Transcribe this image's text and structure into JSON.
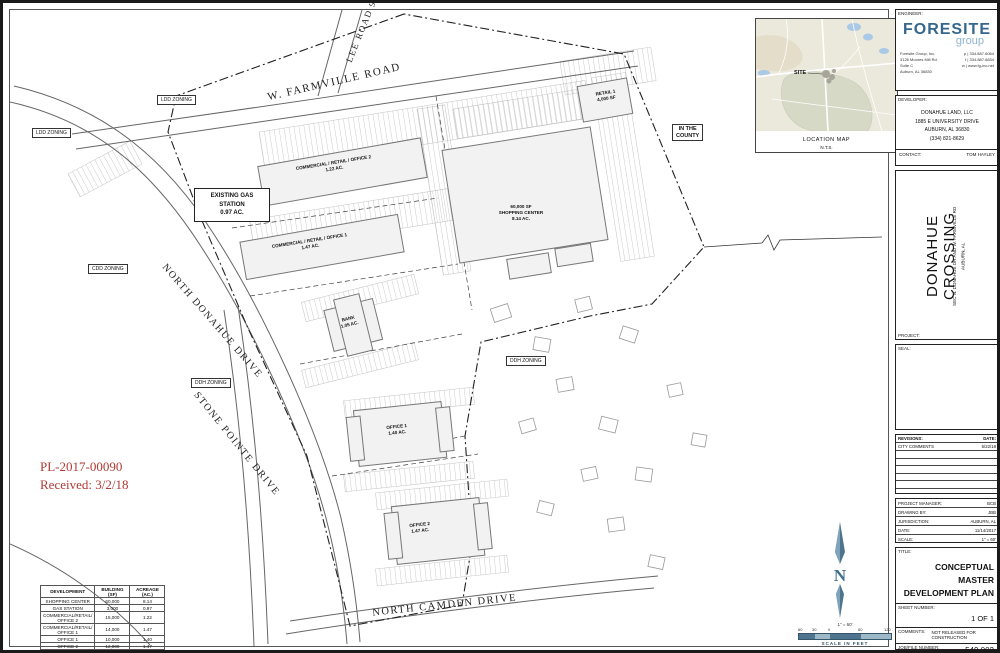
{
  "plan": {
    "roads": {
      "farmville": "W. FARMVILLE ROAD",
      "lee": "LEE ROAD 91",
      "donahue": "NORTH DONAHUE DRIVE",
      "stone_pointe": "STONE POINTE DRIVE",
      "camden": "NORTH CAMDEN DRIVE"
    },
    "zoning": {
      "ldd": "LDD ZONING",
      "cdd": "CDD ZONING",
      "ddh": "DDH ZONING",
      "county1": "IN THE",
      "county2": "COUNTY"
    },
    "parcels": {
      "gas1": "EXISTING GAS STATION",
      "gas2": "0.97 AC.",
      "cro2_1": "COMMERCIAL / RETAIL / OFFICE 2",
      "cro2_2": "1.22 AC.",
      "cro1_1": "COMMERCIAL / RETAIL / OFFICE 1",
      "cro1_2": "1.47 AC.",
      "shop1": "60,000 SF",
      "shop2": "SHOPPING CENTER",
      "shop3": "8.14 AC.",
      "retail1_1": "RETAIL 1",
      "retail1_2": "4,000 SF",
      "bank1": "BANK",
      "bank2": "1.05 AC.",
      "office1_1": "OFFICE 1",
      "office1_2": "1.40 AC.",
      "office2_1": "OFFICE 2",
      "office2_2": "1.47 AC."
    }
  },
  "stamp": {
    "line1": "PL-2017-00090",
    "line2": "Received: 3/2/18",
    "color": "#b03a34"
  },
  "dev_table": {
    "headers": [
      "DEVELOPMENT",
      "BUILDING (SF)",
      "ACREAGE (AC.)"
    ],
    "rows": [
      [
        "SHOPPING CENTER",
        "60,000",
        "8.14"
      ],
      [
        "GAS STATION",
        "3,000",
        "0.97"
      ],
      [
        "COMMERCIAL/RETAIL/ OFFICE 2",
        "15,000",
        "1.22"
      ],
      [
        "COMMERCIAL/RETAIL/ OFFICE 1",
        "14,000",
        "1.47"
      ],
      [
        "OFFICE 1",
        "10,000",
        "1.40"
      ],
      [
        "OFFICE 2",
        "12,000",
        "1.47"
      ],
      [
        "RETAIL 1",
        "4,000",
        ""
      ],
      [
        "BANK",
        "4,000",
        "1.05"
      ]
    ]
  },
  "location_map": {
    "site_label": "SITE",
    "caption1": "LOCATION MAP",
    "caption2": "N.T.S."
  },
  "north_scale": {
    "north_letter": "N",
    "scale_text": "1\" = 60'",
    "ticks": [
      "60",
      "30",
      "0",
      "60",
      "120"
    ],
    "caption": "SCALE IN FEET",
    "arrow_color": "#4e7490",
    "bar_light": "#9db8c6"
  },
  "titleblock": {
    "engineer_label": "ENGINEER:",
    "logo_main": "FORESITE",
    "logo_sub": "group",
    "logo_color": "#35678e",
    "logo_sub_color": "#8fb4cc",
    "firm_left": [
      "Foresite Group, Inc.",
      "3126 Moores Mill Rd.",
      "Suite C",
      "Auburn, AL 36830"
    ],
    "firm_right": [
      "p | 334.887.6064",
      "f | 334.887.6834",
      "w | www.fg-inc.net"
    ],
    "developer_label": "DEVELOPER:",
    "developer_lines": [
      "DONAHUE LAND, LLC",
      "1885 E UNIVERSITY DRIVE",
      "AUBURN, AL 36830",
      "(334) 821-8629"
    ],
    "contact_label": "CONTACT:",
    "contact_value": "TOM HAYLEY",
    "project_label": "PROJECT:",
    "project_title": "DONAHUE CROSSING",
    "project_sub1": "SEC N. DONAHUE DR AND W. FARMVILLE RD",
    "project_sub2": "AUBURN, AL",
    "seal_label": "SEAL:",
    "revisions_label": "REVISIONS:",
    "date_label": "DATE:",
    "revision_name": "CITY COMMENTS",
    "revision_date": "6/22/18",
    "info": [
      {
        "label": "PROJECT MANAGER:",
        "value": "BCB"
      },
      {
        "label": "DRAWING BY:",
        "value": "JBB"
      },
      {
        "label": "JURISDICTION:",
        "value": "AUBURN, AL"
      },
      {
        "label": "DATE:",
        "value": "11/14/2017"
      },
      {
        "label": "SCALE:",
        "value": "1\" = 60'"
      }
    ],
    "title_label": "TITLE:",
    "sheet_title1": "CONCEPTUAL MASTER",
    "sheet_title2": "DEVELOPMENT PLAN",
    "sheet_number_label": "SHEET NUMBER:",
    "sheet_number": "1 OF 1",
    "comments_label": "COMMENTS:",
    "comments_value": "NOT RELEASED FOR CONSTRUCTION",
    "job_label": "JOB/FILE NUMBER:",
    "job_number": "549.002"
  }
}
